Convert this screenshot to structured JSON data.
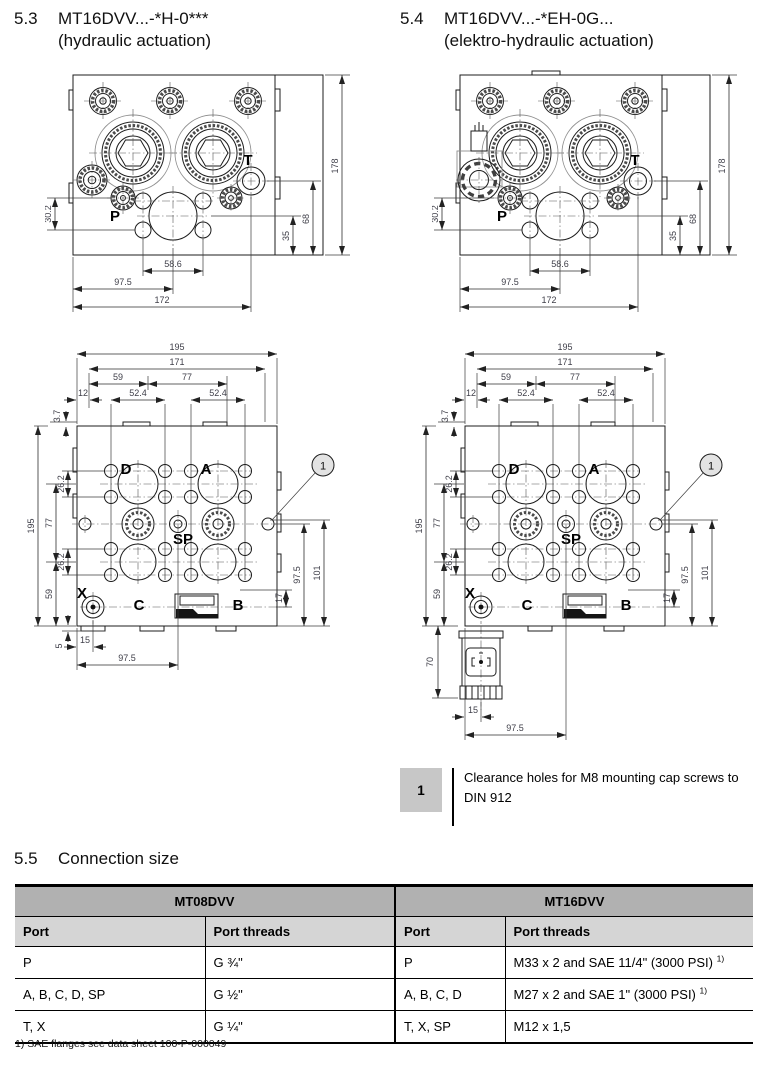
{
  "sections": {
    "s53": {
      "number": "5.3",
      "code": "MT16DVV...-*H-0***",
      "subtitle": "(hydraulic actuation)"
    },
    "s54": {
      "number": "5.4",
      "code": "MT16DVV...-*EH-0G...",
      "subtitle": "(elektro-hydraulic actuation)"
    },
    "s55": {
      "number": "5.5",
      "title": "Connection size"
    }
  },
  "top_view": {
    "labels": {
      "p": "P",
      "t": "T"
    },
    "dims": {
      "w30_2": "30.2",
      "h35": "35",
      "h68": "68",
      "h178": "178",
      "w58_6": "58.6",
      "w97_5": "97.5",
      "w172": "172"
    }
  },
  "bottom_view": {
    "labels": {
      "d": "D",
      "a": "A",
      "sp": "SP",
      "x": "X",
      "c": "C",
      "b": "B"
    },
    "callout": "1",
    "dims": {
      "w195": "195",
      "w171": "171",
      "w59": "59",
      "w77": "77",
      "w12": "12",
      "w52_4": "52.4",
      "h3_7": "3.7",
      "h195": "195",
      "h77": "77",
      "h26_2": "26.2",
      "h59": "59",
      "h5": "5",
      "h17": "17",
      "h97_5": "97.5",
      "h101": "101",
      "h70": "70",
      "w15": "15",
      "w97_5": "97.5"
    }
  },
  "note": {
    "badge": "1",
    "text": "Clearance holes for M8 mounting cap screws to DIN 912"
  },
  "table": {
    "groups": {
      "mt08": "MT08DVV",
      "mt16": "MT16DVV"
    },
    "headers": {
      "port": "Port",
      "threads": "Port threads"
    },
    "rows": [
      {
        "port08": "P",
        "thread08": "G ¾\"",
        "port16": "P",
        "thread16": "M33 x 2 and SAE 11/4\" (3000 PSI)",
        "sup": "1)"
      },
      {
        "port08": "A, B, C, D, SP",
        "thread08": "G ½\"",
        "port16": "A, B, C, D",
        "thread16": "M27 x 2 and SAE 1\" (3000 PSI)",
        "sup": "1)"
      },
      {
        "port08": "T, X",
        "thread08": "G ¼\"",
        "port16": "T, X, SP",
        "thread16": "M12 x 1,5",
        "sup": ""
      }
    ],
    "footnote": "1) SAE flanges see data sheet 100-P-000049"
  }
}
